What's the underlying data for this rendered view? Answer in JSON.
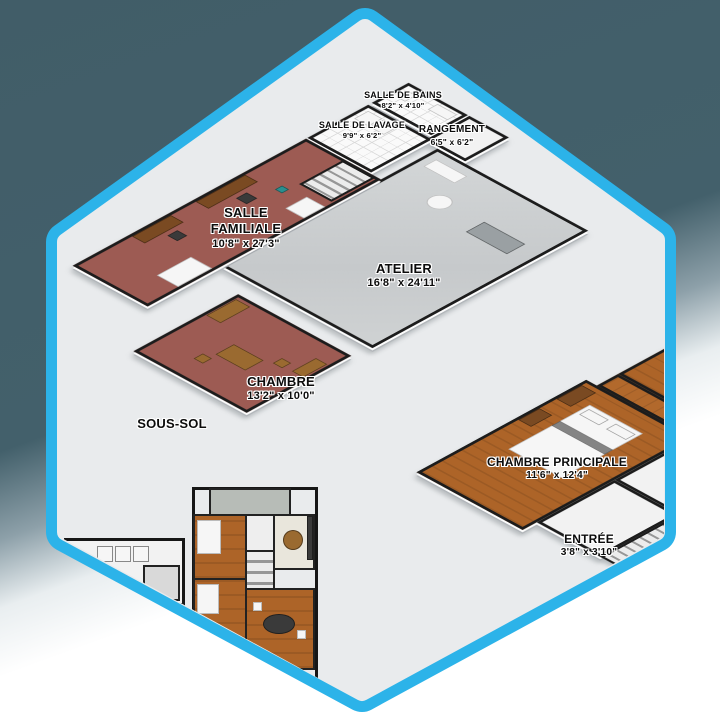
{
  "colors": {
    "badge_border": "#2cb3e9",
    "badge_interior": "#e9ebed",
    "background_top": "#43606b",
    "background_bottom": "#ffffff",
    "carpet": "#9d5b53",
    "concrete": "#cfd2d3",
    "wood_floor": "#b2692c",
    "walls": "#1c1c1c"
  },
  "level_label": "SOUS-SOL",
  "basement_rooms": [
    {
      "name": "SALLE DE BAINS",
      "dims": "8'2\" x 4'10\""
    },
    {
      "name": "SALLE DE LAVAGE",
      "dims": "9'9\" x 6'2\""
    },
    {
      "name": "RANGEMENT",
      "dims": "6'5\" x 6'2\""
    },
    {
      "name": "SALLE FAMILIALE",
      "dims": "10'8\" x 27'3\""
    },
    {
      "name": "ATELIER",
      "dims": "16'8\" x 24'11\""
    },
    {
      "name": "CHAMBRE",
      "dims": "13'2\" x 10'0\""
    }
  ],
  "main_floor_rooms": [
    {
      "name": "CHAMBRE PRINCIPALE",
      "dims": "11'6\" x 12'4\""
    },
    {
      "name": "ENTRÉE",
      "dims": "3'8\" x 3'10\""
    },
    {
      "name": "CHAMBRE",
      "dims": "11'6\""
    }
  ]
}
